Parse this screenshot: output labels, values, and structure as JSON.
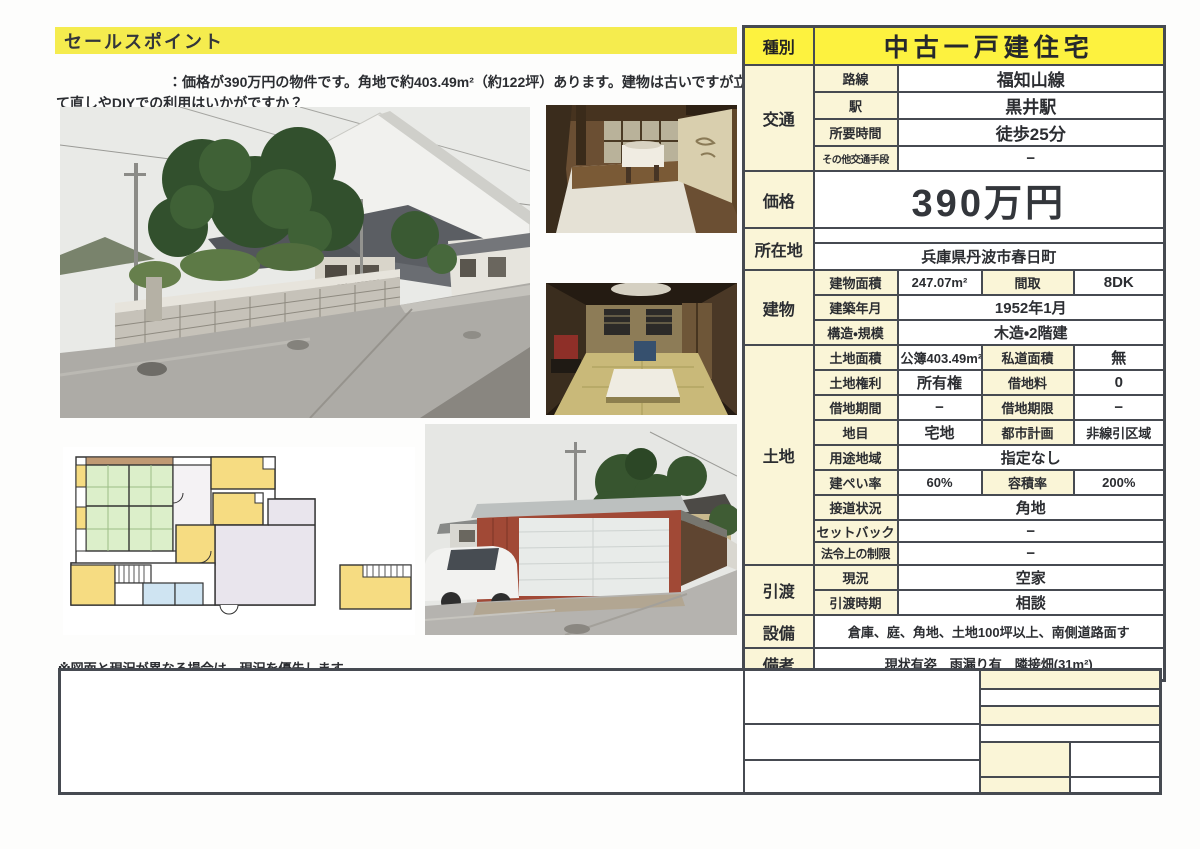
{
  "colors": {
    "highlight_yellow": "#f5ec4e",
    "type_row_yellow": "#fdf23f",
    "label_cream": "#faf5d7",
    "table_border": "#464a51"
  },
  "sales": {
    "header": "セールスポイント",
    "body": "：価格が390万円の物件です。角地で約403.49m²（約122坪）あります。建物は古いですが立て直しやDIYでの利用はいかがですか？"
  },
  "note": "※図面と現況が異なる場合は、現況を優先します。",
  "spec": {
    "type": {
      "label": "種別",
      "value": "中古一戸建住宅"
    },
    "transport": {
      "label": "交通",
      "rows": [
        {
          "k": "路線",
          "v": "福知山線"
        },
        {
          "k": "駅",
          "v": "黒井駅"
        },
        {
          "k": "所要時間",
          "v": "徒歩25分"
        },
        {
          "k": "その他交通手段",
          "v": "−"
        }
      ]
    },
    "price": {
      "label": "価格",
      "value": "390万円"
    },
    "location": {
      "label": "所在地",
      "value": "兵庫県丹波市春日町"
    },
    "building": {
      "label": "建物",
      "row1": {
        "k1": "建物面積",
        "v1": "247.07m²",
        "k2": "間取",
        "v2": "8DK"
      },
      "row2": {
        "k": "建築年月",
        "v": "1952年1月"
      },
      "row3": {
        "k": "構造・規模",
        "v": "木造・2階建"
      }
    },
    "land": {
      "label": "土地",
      "row1": {
        "k1": "土地面積",
        "v1": "公簿403.49m²",
        "k2": "私道面積",
        "v2": "無"
      },
      "row2": {
        "k1": "土地権利",
        "v1": "所有権",
        "k2": "借地料",
        "v2": "0"
      },
      "row3": {
        "k1": "借地期間",
        "v1": "−",
        "k2": "借地期限",
        "v2": "−"
      },
      "row4": {
        "k1": "地目",
        "v1": "宅地",
        "k2": "都市計画",
        "v2": "非線引区域"
      },
      "row5": {
        "k": "用途地域",
        "v": "指定なし"
      },
      "row6": {
        "k1": "建ぺい率",
        "v1": "60%",
        "k2": "容積率",
        "v2": "200%"
      },
      "row7": {
        "k": "接道状況",
        "v": "角地"
      },
      "row8": {
        "k": "セットバック",
        "v": "−"
      },
      "row9": {
        "k": "法令上の制限",
        "v": "−"
      }
    },
    "handover": {
      "label": "引渡",
      "rows": [
        {
          "k": "現況",
          "v": "空家"
        },
        {
          "k": "引渡時期",
          "v": "相談"
        }
      ]
    },
    "facilities": {
      "label": "設備",
      "value": "倉庫、庭、角地、土地100坪以上、南側道路面す"
    },
    "remarks": {
      "label": "備考",
      "value": "現状有姿　雨漏り有　隣接畑(31m²)"
    }
  }
}
